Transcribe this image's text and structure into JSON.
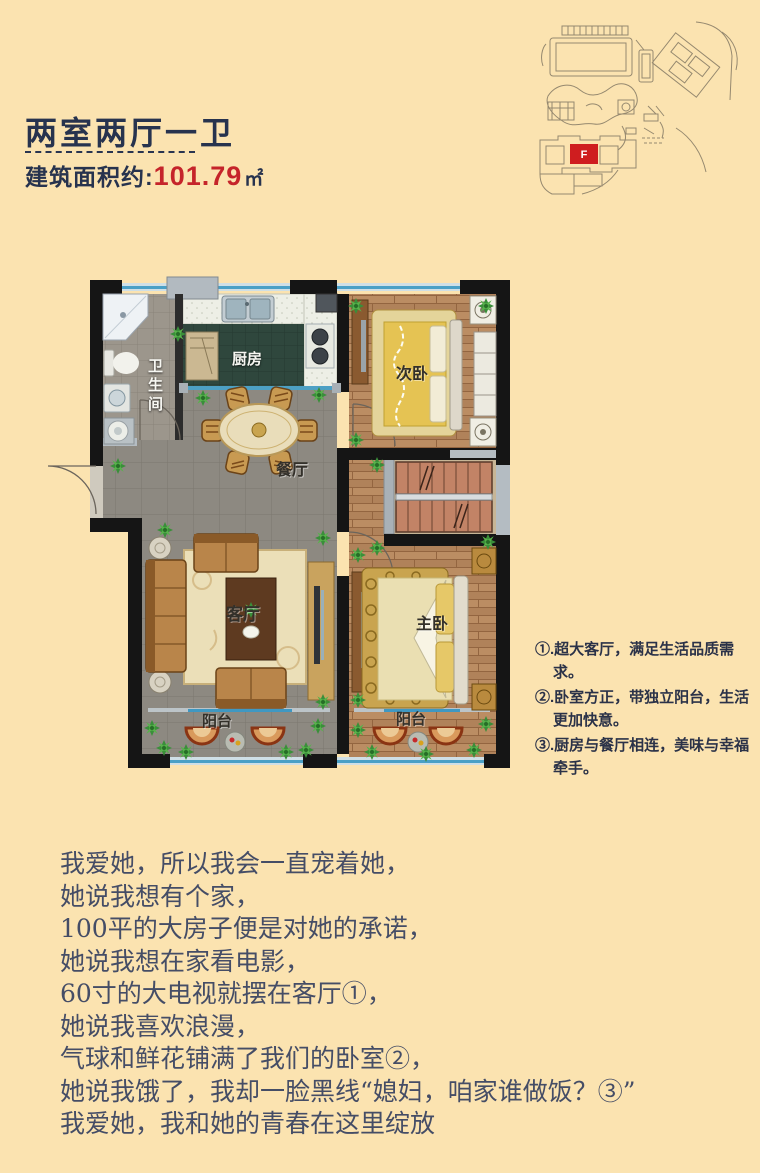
{
  "page": {
    "background_color": "#fbe3b0"
  },
  "header": {
    "title": "两室两厅一卫",
    "area_label": "建筑面积约:",
    "area_value": "101.79",
    "area_unit": "㎡",
    "title_color": "#27334e",
    "accent_red": "#c5242a"
  },
  "site_plan": {
    "building_label": "F",
    "highlight_color": "#cf1d1f"
  },
  "floor_plan": {
    "rooms": [
      {
        "id": "bathroom",
        "label": "卫生间"
      },
      {
        "id": "kitchen",
        "label": "厨房"
      },
      {
        "id": "dining",
        "label": "餐厅"
      },
      {
        "id": "second-bedroom",
        "label": "次卧"
      },
      {
        "id": "living-room",
        "label": "客厅"
      },
      {
        "id": "master-bedroom",
        "label": "主卧"
      },
      {
        "id": "balcony-living",
        "label": "阳台"
      },
      {
        "id": "balcony-master",
        "label": "阳台"
      }
    ]
  },
  "features": {
    "items": [
      "①.超大客厅，满足生活品质需求。",
      "②.卧室方正，带独立阳台，生活 更加快意。",
      "③.厨房与餐厅相连，美味与幸福牵手。"
    ]
  },
  "poem": {
    "lines": [
      "我爱她，所以我会一直宠着她，",
      "她说我想有个家，",
      "100平的大房子便是对她的承诺，",
      "她说我想在家看电影，",
      "60寸的大电视就摆在客厅①，",
      "她说我喜欢浪漫，",
      "气球和鲜花铺满了我们的卧室②，",
      "她说我饿了，我却一脸黑线“媳妇，咱家谁做饭？③”",
      "我爱她，我和她的青春在这里绽放"
    ]
  }
}
